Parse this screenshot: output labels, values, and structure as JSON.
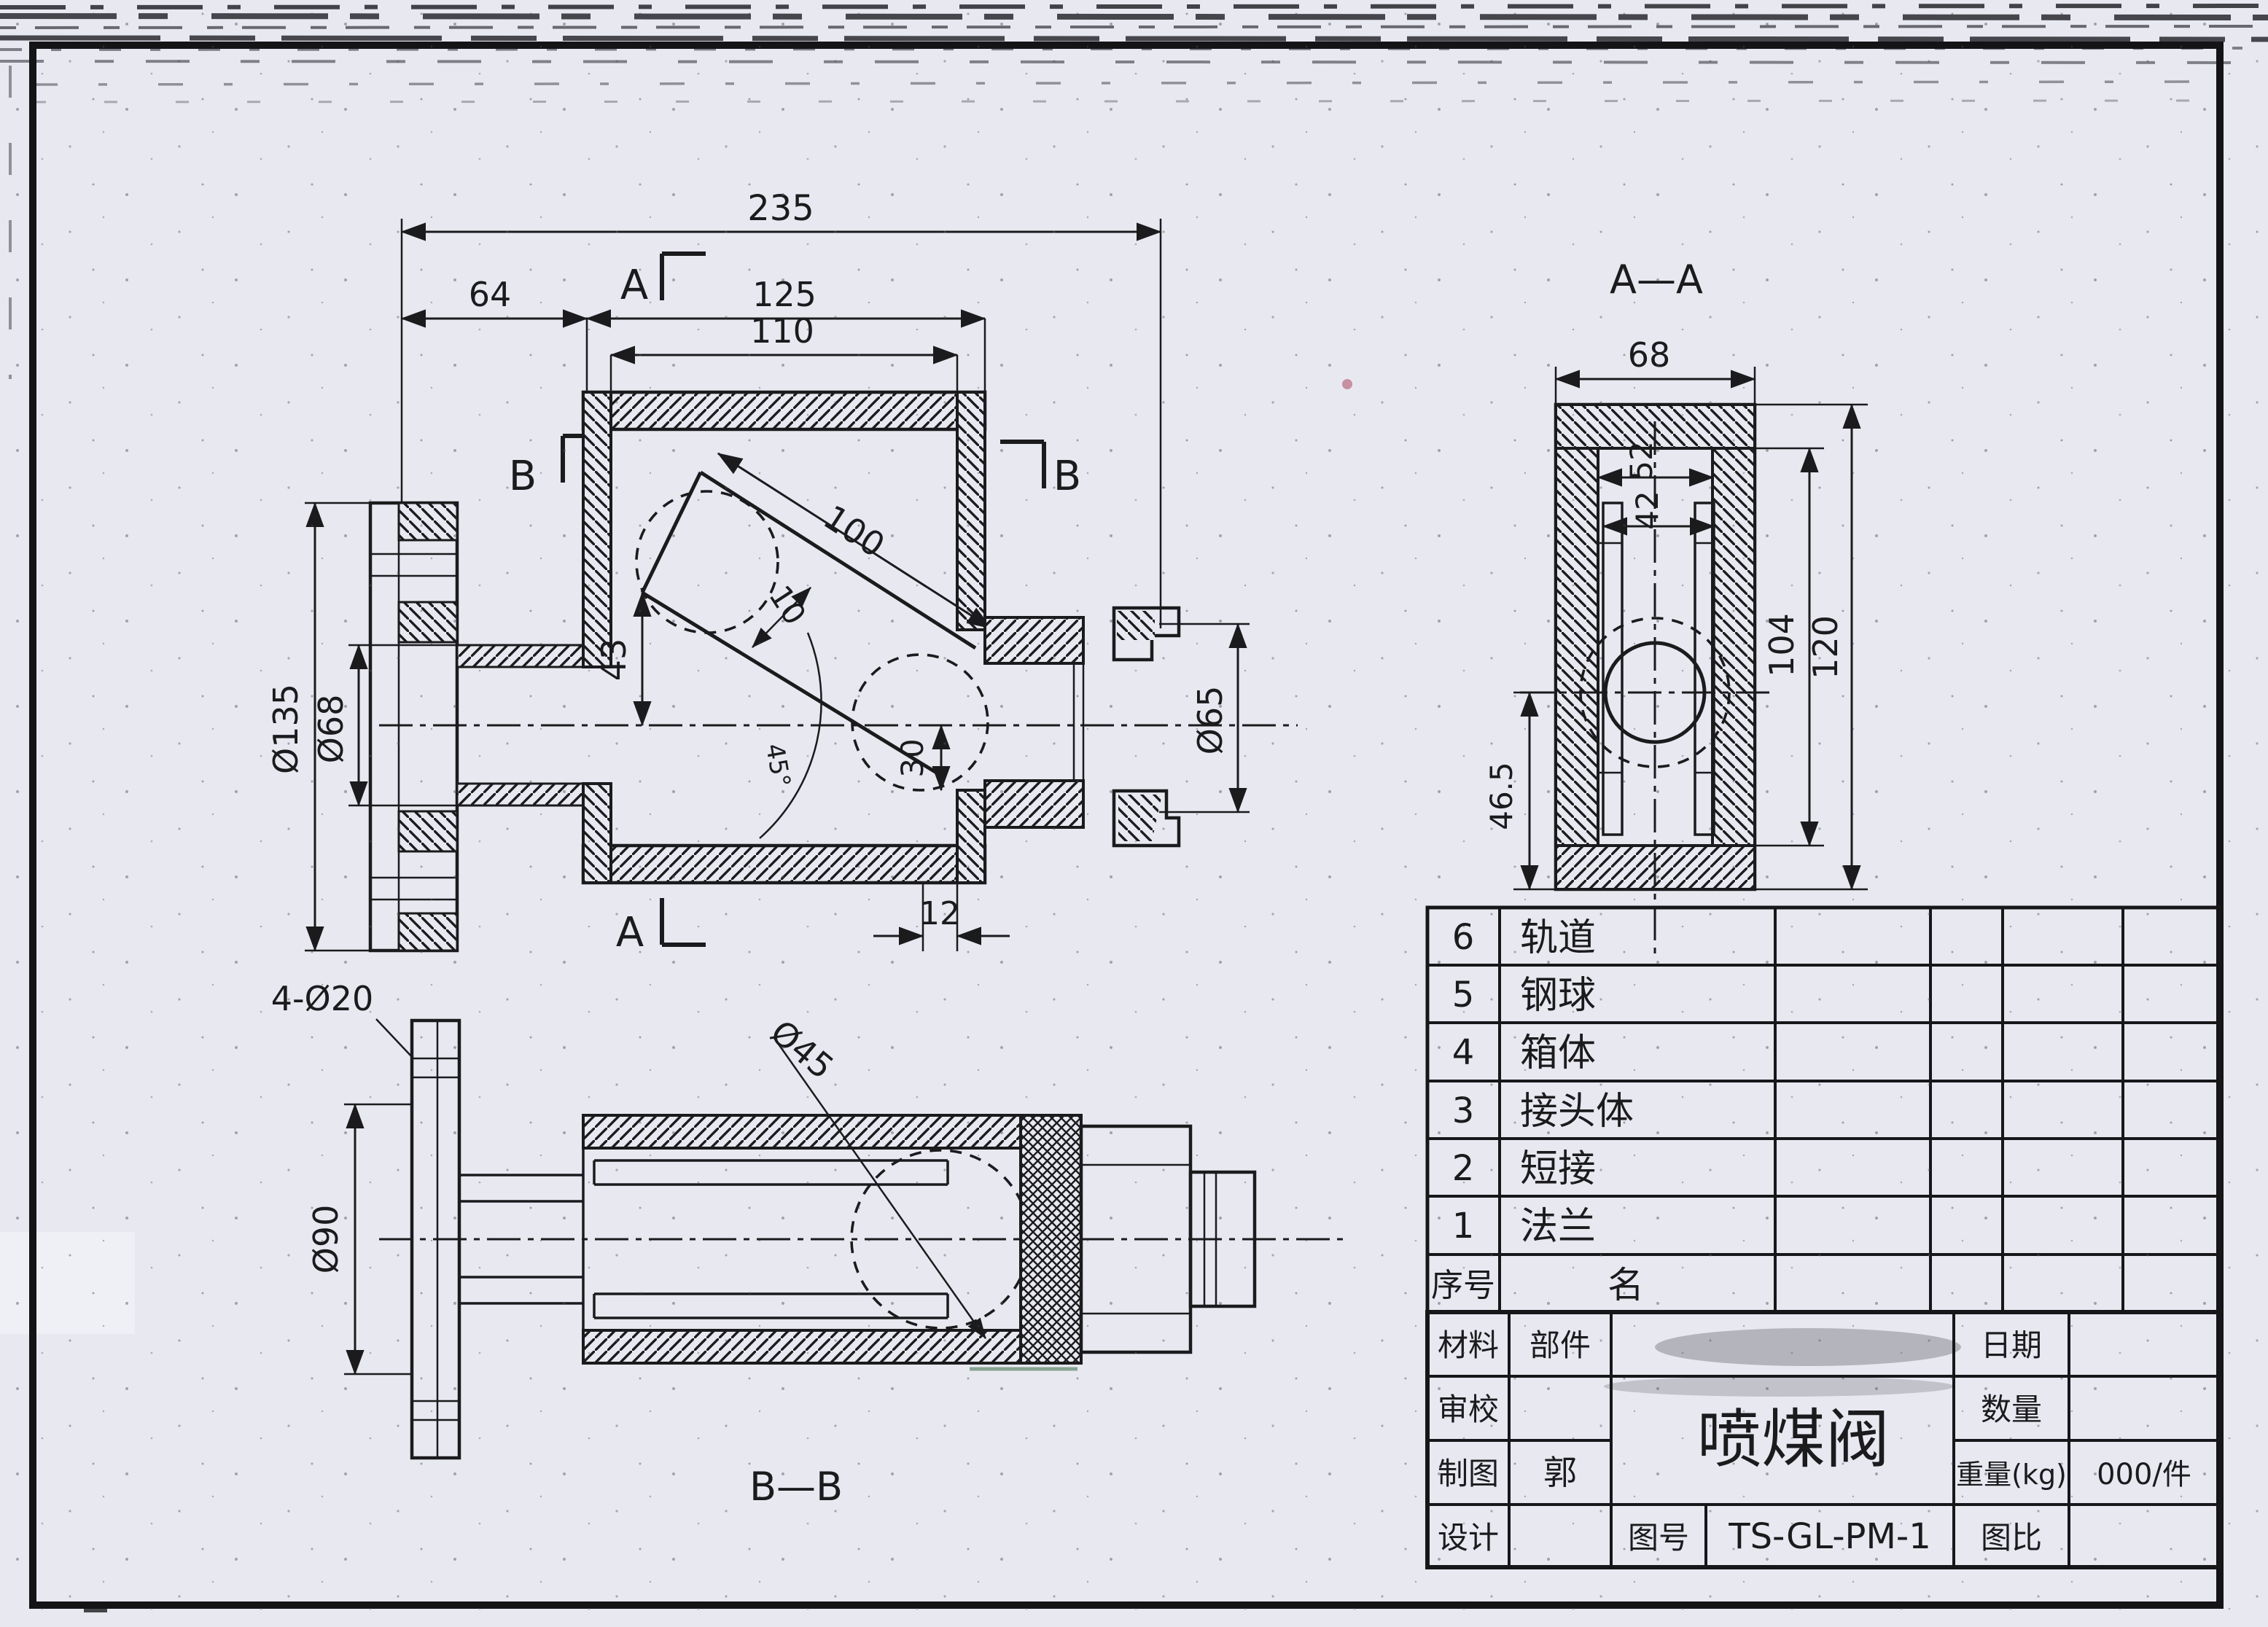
{
  "front": {
    "section_label_a": "A",
    "section_label_b": "B",
    "dim_total": "235",
    "dim_left": "64",
    "dim_body": "125",
    "dim_cavity": "110",
    "dim_flange_od": "Ø135",
    "dim_hub_od": "Ø68",
    "dim_track_len": "100",
    "dim_track_w": "10",
    "dim_track_h": "43",
    "dim_angle": "45°",
    "dim_drop": "30",
    "dim_outlet": "Ø65",
    "dim_step": "12"
  },
  "section_aa": {
    "title": "A—A",
    "dim_width": "68",
    "dim_inner": "52",
    "dim_rail": "42",
    "dim_inner_h": "104",
    "dim_height": "120",
    "dim_offset": "46.5"
  },
  "section_bb": {
    "title": "B—B",
    "dim_holes": "4-Ø20",
    "dim_bolt_circle": "Ø90",
    "dim_ball": "Ø45"
  },
  "parts_list": {
    "header_no": "序号",
    "header_name": "名",
    "rows": [
      {
        "no": "6",
        "name": "轨道"
      },
      {
        "no": "5",
        "name": "钢球"
      },
      {
        "no": "4",
        "name": "箱体"
      },
      {
        "no": "3",
        "name": "接头体"
      },
      {
        "no": "2",
        "name": "短接"
      },
      {
        "no": "1",
        "name": "法兰"
      }
    ]
  },
  "title_block": {
    "material": "材料",
    "part": "部件",
    "check": "审校",
    "draft": "制图",
    "draft_name": "郭",
    "design": "设计",
    "title": "喷煤阀",
    "no_label": "图号",
    "no_value": "TS-GL-PM-1",
    "date": "日期",
    "qty": "数量",
    "weight": "重量(kg)",
    "weight_value": "000/件",
    "scale": "图比"
  }
}
